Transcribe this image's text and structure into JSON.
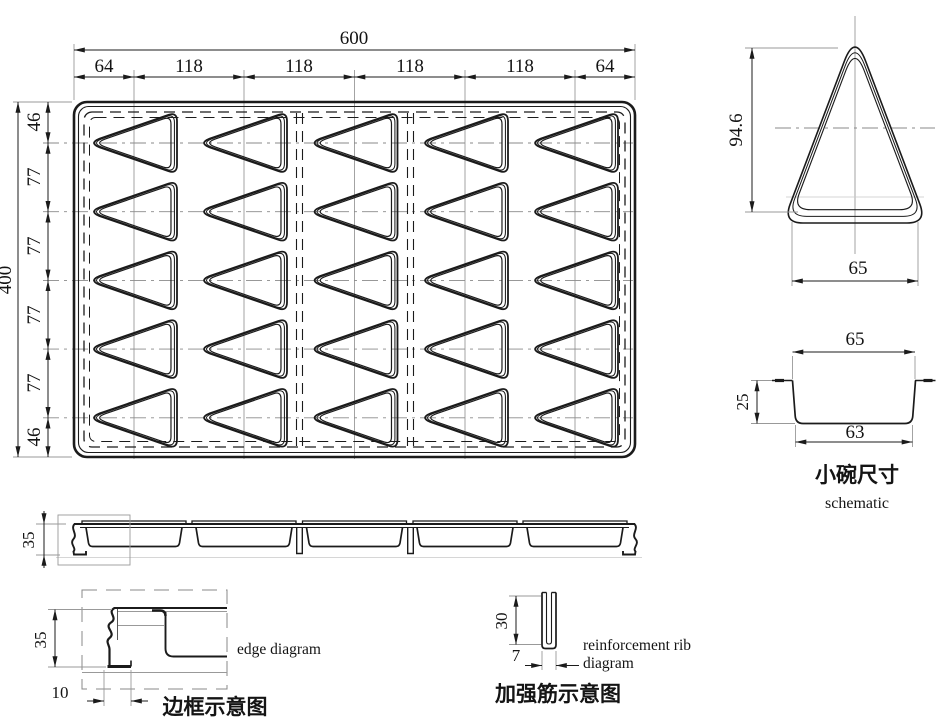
{
  "plan": {
    "total_width": "600",
    "total_height": "400",
    "top_segments": [
      "64",
      "118",
      "118",
      "118",
      "118",
      "64"
    ],
    "left_segments": [
      "46",
      "77",
      "77",
      "77",
      "77",
      "46"
    ]
  },
  "cavity_detail": {
    "height": "94.6",
    "base_width": "65"
  },
  "bowl": {
    "top_width": "65",
    "depth": "25",
    "bottom_width": "63",
    "caption_zh": "小碗尺寸",
    "caption_en": "schematic"
  },
  "side_view": {
    "height": "35"
  },
  "edge_detail": {
    "height": "35",
    "foot_width": "10",
    "caption_en": "edge diagram",
    "caption_zh": "边框示意图"
  },
  "rib_detail": {
    "height": "30",
    "width": "7",
    "caption_en_line1": "reinforcement rib",
    "caption_en_line2": "diagram",
    "caption_zh": "加强筋示意图"
  },
  "colors": {
    "line": "#1b1b1b",
    "thin_line": "#999999",
    "background": "#ffffff"
  }
}
